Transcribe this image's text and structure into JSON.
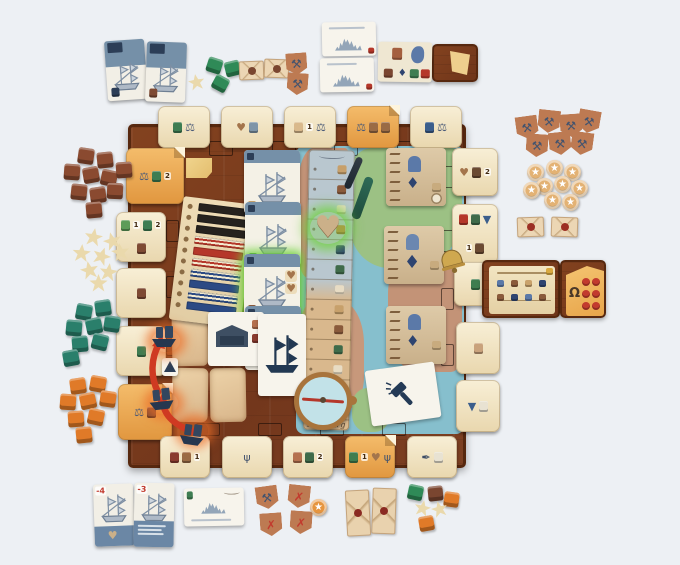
{
  "meta": {
    "scene": "Tabletop photo: board game set up mid-play (city-building/shipping game on wooden harbor board)",
    "background_color": "#edf0f4"
  },
  "labels": {
    "track_bottom": "Hamburg"
  },
  "corner_numbers": {
    "bottom_ship_card_1": "-4",
    "bottom_ship_card_2": "-3"
  },
  "icons": {
    "heart": {
      "g": "♥",
      "c": "#a4754c"
    },
    "scale": {
      "g": "⚖",
      "c": "#4a5a78"
    },
    "star": {
      "g": "★",
      "c": "#ffffff"
    },
    "cross": {
      "g": "✗",
      "c": "#c23b2e"
    },
    "tools": {
      "g": "⚒",
      "c": "#44546e"
    },
    "trident": {
      "g": "ψ",
      "c": "#44546e"
    },
    "quill": {
      "g": "✒",
      "c": "#3c4c66"
    },
    "diamond": {
      "g": "♦",
      "c": "#2e4470"
    },
    "horseshoe": {
      "g": "Ω",
      "c": "#4a3828"
    },
    "funnel": {
      "g": "▼",
      "c": "#3b5e8c"
    },
    "jug": {
      "c": "#3e7d52"
    },
    "sack": {
      "c": "#9a6b45"
    },
    "pouch": {
      "c": "#7e4a33"
    },
    "bottle": {
      "c": "#3b5e8c"
    },
    "jar": {
      "c": "#3f7d4f"
    },
    "candle_red": {
      "c": "#b5372a"
    },
    "candle_green": {
      "c": "#3f6b4a"
    },
    "leaf": {
      "c": "#5d9c59"
    },
    "seal": {
      "c": "#8a3b2f"
    },
    "doc": {
      "c": "#e8e2d2"
    },
    "pig": {
      "c": "#c9a27c"
    },
    "mountain": {
      "c": "#7f95a8"
    },
    "shield": {
      "c": "#b5714f"
    },
    "leather": {
      "c": "#d9b98c"
    },
    "pot": {
      "c": "#6b4a32"
    }
  },
  "board": {
    "wood_color": "#7b3d20",
    "edge_color": "#57280f",
    "track": {
      "bottom_label": "Hamburg",
      "row_colors": [
        "#c7a06b",
        "#8a5a3b",
        "#e8dcc4",
        "#b8893f",
        "#2e4470",
        "#3f6b4a",
        "#e8dcc4",
        "#c7a06b",
        "#8a5a3b",
        "#3f6b4a",
        "#e8dcc4",
        "#b8893f",
        "#c7a06b"
      ]
    },
    "slot_outlines": [
      [
        209,
        141,
        24,
        15
      ],
      [
        272,
        141,
        24,
        15
      ],
      [
        334,
        141,
        24,
        15
      ],
      [
        397,
        141,
        24,
        15
      ],
      [
        166,
        163,
        13,
        22
      ],
      [
        166,
        220,
        13,
        22
      ],
      [
        166,
        276,
        13,
        22
      ],
      [
        166,
        334,
        13,
        22
      ],
      [
        441,
        166,
        13,
        22
      ],
      [
        441,
        230,
        13,
        22
      ],
      [
        441,
        288,
        13,
        22
      ],
      [
        441,
        344,
        13,
        22
      ],
      [
        196,
        423,
        24,
        13
      ],
      [
        258,
        423,
        24,
        13
      ],
      [
        320,
        423,
        24,
        13
      ],
      [
        382,
        423,
        24,
        13
      ]
    ],
    "edge_cards": [
      {
        "name": "top-edge-card-1",
        "x": 158,
        "y": 106,
        "w": 52,
        "h": 42,
        "icons": [
          {
            "k": "jug"
          },
          {
            "k": "scale"
          }
        ]
      },
      {
        "name": "top-edge-card-2",
        "x": 221,
        "y": 106,
        "w": 52,
        "h": 42,
        "icons": [
          {
            "k": "heart"
          },
          {
            "k": "mountain"
          }
        ]
      },
      {
        "name": "top-edge-card-3",
        "x": 284,
        "y": 106,
        "w": 52,
        "h": 42,
        "icons": [
          {
            "k": "leather",
            "n": "1"
          },
          {
            "k": "scale"
          }
        ]
      },
      {
        "name": "top-edge-card-4",
        "x": 347,
        "y": 106,
        "w": 52,
        "h": 42,
        "variant": "orange",
        "icons": [
          {
            "k": "scale"
          },
          {
            "k": "sack"
          },
          {
            "k": "sack"
          }
        ]
      },
      {
        "name": "top-edge-card-5",
        "x": 410,
        "y": 106,
        "w": 52,
        "h": 42,
        "icons": [
          {
            "k": "bottle"
          },
          {
            "k": "scale"
          }
        ]
      },
      {
        "name": "top-left-corner-card",
        "x": 126,
        "y": 148,
        "w": 58,
        "h": 56,
        "variant": "orange",
        "icons": [
          {
            "k": "scale"
          },
          {
            "k": "jug",
            "n": "2"
          }
        ]
      },
      {
        "name": "left-edge-card-2",
        "x": 116,
        "y": 212,
        "w": 50,
        "h": 50,
        "icons": [
          {
            "k": "leaf",
            "n": "1"
          },
          {
            "k": "jug",
            "n": "2"
          },
          {
            "k": "pouch"
          }
        ]
      },
      {
        "name": "left-edge-card-3",
        "x": 116,
        "y": 268,
        "w": 50,
        "h": 50,
        "icons": [
          {
            "k": "pouch"
          }
        ]
      },
      {
        "name": "left-edge-card-4",
        "x": 116,
        "y": 326,
        "w": 50,
        "h": 50,
        "icons": [
          {
            "k": "jug"
          }
        ]
      },
      {
        "name": "bottom-left-corner-card",
        "x": 118,
        "y": 384,
        "w": 54,
        "h": 56,
        "variant": "orange",
        "icons": [
          {
            "k": "scale"
          },
          {
            "k": "pouch"
          }
        ]
      },
      {
        "name": "right-edge-card-1",
        "x": 452,
        "y": 148,
        "w": 46,
        "h": 48,
        "icons": [
          {
            "k": "heart"
          },
          {
            "k": "pot",
            "n": "2"
          }
        ]
      },
      {
        "name": "right-edge-card-2",
        "x": 452,
        "y": 204,
        "w": 46,
        "h": 60,
        "icons": [
          {
            "k": "candle_red"
          },
          {
            "k": "candle_green"
          },
          {
            "k": "funnel",
            "n": "1"
          },
          {
            "k": "pot"
          }
        ]
      },
      {
        "name": "right-edge-card-3",
        "x": 454,
        "y": 262,
        "w": 42,
        "h": 44,
        "icons": [
          {
            "k": "jar"
          }
        ]
      },
      {
        "name": "right-edge-card-4",
        "x": 456,
        "y": 322,
        "w": 44,
        "h": 52,
        "icons": [
          {
            "k": "pig"
          }
        ]
      },
      {
        "name": "right-edge-card-5",
        "x": 456,
        "y": 380,
        "w": 44,
        "h": 52,
        "icons": [
          {
            "k": "funnel"
          },
          {
            "k": "doc"
          }
        ]
      },
      {
        "name": "bottom-edge-card-1",
        "x": 160,
        "y": 436,
        "w": 50,
        "h": 42,
        "icons": [
          {
            "k": "seal"
          },
          {
            "k": "sack",
            "n": "1"
          }
        ]
      },
      {
        "name": "bottom-edge-card-2",
        "x": 222,
        "y": 436,
        "w": 50,
        "h": 42,
        "icons": [
          {
            "k": "trident"
          }
        ]
      },
      {
        "name": "bottom-edge-card-3",
        "x": 283,
        "y": 436,
        "w": 50,
        "h": 42,
        "icons": [
          {
            "k": "shield"
          },
          {
            "k": "candle_green",
            "n": "2"
          }
        ]
      },
      {
        "name": "bottom-edge-card-4",
        "x": 345,
        "y": 436,
        "w": 50,
        "h": 42,
        "variant": "orange",
        "icons": [
          {
            "k": "jar",
            "n": "1"
          },
          {
            "k": "heart"
          },
          {
            "k": "trident"
          }
        ]
      },
      {
        "name": "bottom-edge-card-5",
        "x": 407,
        "y": 436,
        "w": 50,
        "h": 42,
        "icons": [
          {
            "k": "quill"
          },
          {
            "k": "doc"
          }
        ]
      }
    ]
  },
  "score_panel": {
    "rows": [
      "black",
      "black",
      "black",
      "red_stripe",
      "red",
      "red_stripe",
      "blue_stripe",
      "blue",
      "blue_stripe",
      "blue"
    ]
  },
  "token_piles": [
    {
      "name": "brown-goods-cubes",
      "shape": "cube",
      "size": 16,
      "color": "#8a4a30",
      "items": [
        [
          78,
          148,
          8
        ],
        [
          97,
          152,
          -6
        ],
        [
          64,
          164,
          4
        ],
        [
          83,
          167,
          -10
        ],
        [
          101,
          170,
          12
        ],
        [
          116,
          162,
          -4
        ],
        [
          71,
          184,
          6
        ],
        [
          90,
          187,
          -8
        ],
        [
          107,
          183,
          3
        ],
        [
          86,
          202,
          -5
        ]
      ]
    },
    {
      "name": "cream-star-meeples",
      "shape": "star",
      "size": 19,
      "color": "#ead9ac",
      "items": [
        [
          84,
          228,
          10
        ],
        [
          103,
          232,
          -15
        ],
        [
          72,
          244,
          5
        ],
        [
          92,
          247,
          20
        ],
        [
          111,
          243,
          -8
        ],
        [
          80,
          261,
          -12
        ],
        [
          99,
          263,
          8
        ],
        [
          89,
          274,
          0
        ]
      ]
    },
    {
      "name": "teal-goods-cubes",
      "shape": "cube",
      "size": 16,
      "color": "#2a7f6b",
      "items": [
        [
          76,
          304,
          10
        ],
        [
          95,
          300,
          -8
        ],
        [
          66,
          320,
          5
        ],
        [
          86,
          318,
          -12
        ],
        [
          104,
          316,
          8
        ],
        [
          72,
          336,
          -5
        ],
        [
          92,
          334,
          14
        ],
        [
          63,
          350,
          -10
        ]
      ]
    },
    {
      "name": "orange-goods-cubes",
      "shape": "cube",
      "size": 16,
      "color": "#e07a28",
      "items": [
        [
          70,
          378,
          -8
        ],
        [
          90,
          376,
          10
        ],
        [
          60,
          394,
          4
        ],
        [
          80,
          393,
          -12
        ],
        [
          100,
          391,
          8
        ],
        [
          68,
          411,
          -4
        ],
        [
          88,
          409,
          12
        ],
        [
          76,
          427,
          -6
        ]
      ]
    },
    {
      "name": "green-goods-cubes",
      "shape": "cube",
      "size": 15,
      "color": "#2f8a57",
      "items": [
        [
          207,
          58,
          18
        ],
        [
          225,
          61,
          -14
        ],
        [
          213,
          76,
          28
        ]
      ]
    },
    {
      "name": "cream-star-meeple-single",
      "shape": "star",
      "size": 17,
      "color": "#ead9ac",
      "items": [
        [
          188,
          74,
          -10
        ]
      ]
    },
    {
      "name": "letter-tokens-brown-seal",
      "shape": "env",
      "size": 25,
      "color": "#ecd6b4",
      "seal": "#7a4630",
      "items": [
        [
          239,
          61,
          -2
        ],
        [
          264,
          59,
          2
        ]
      ]
    },
    {
      "name": "guild-badges-top-left",
      "shape": "badge",
      "size": 21,
      "color": "#bd7a52",
      "glyph": "tools",
      "items": [
        [
          286,
          53,
          -4
        ],
        [
          287,
          73,
          4
        ]
      ]
    },
    {
      "name": "guild-badges-pile",
      "shape": "badge",
      "size": 22,
      "color": "#bd7a52",
      "glyph": "tools",
      "items": [
        [
          516,
          116,
          -8
        ],
        [
          538,
          110,
          6
        ],
        [
          560,
          114,
          -4
        ],
        [
          578,
          110,
          10
        ],
        [
          526,
          134,
          4
        ],
        [
          549,
          132,
          -6
        ],
        [
          571,
          132,
          8
        ]
      ]
    },
    {
      "name": "star-coins-pile",
      "shape": "coin",
      "size": 17,
      "color": "#e3b274",
      "glyph": "star",
      "items": [
        [
          527,
          164,
          0
        ],
        [
          546,
          160,
          0
        ],
        [
          564,
          164,
          0
        ],
        [
          536,
          178,
          0
        ],
        [
          554,
          176,
          0
        ],
        [
          571,
          180,
          0
        ],
        [
          523,
          182,
          0
        ],
        [
          544,
          192,
          0
        ],
        [
          562,
          194,
          0
        ]
      ]
    },
    {
      "name": "letter-tokens-red-seal",
      "shape": "env",
      "size": 27,
      "color": "#ecd6b4",
      "seal": "#9c2f24",
      "items": [
        [
          517,
          217,
          -2
        ],
        [
          551,
          217,
          2
        ]
      ]
    },
    {
      "name": "badge-crossed-tools",
      "shape": "badge",
      "size": 22,
      "color": "#bd7a52",
      "glyph": "tools",
      "items": [
        [
          256,
          486,
          -8
        ]
      ]
    },
    {
      "name": "badges-red-x",
      "shape": "badge",
      "size": 22,
      "color": "#bd7a52",
      "glyph": "cross",
      "items": [
        [
          288,
          485,
          6
        ],
        [
          260,
          513,
          -4
        ],
        [
          290,
          511,
          4
        ]
      ]
    },
    {
      "name": "orange-star-coin",
      "shape": "coin",
      "size": 17,
      "color": "#e6953f",
      "glyph": "star",
      "items": [
        [
          310,
          499,
          0
        ]
      ]
    },
    {
      "name": "letter-tokens-portrait",
      "shape": "envp",
      "size": 24,
      "color": "#e9d2ae",
      "seal": "#8a2a22",
      "items": [
        [
          346,
          490,
          -3
        ],
        [
          372,
          488,
          2
        ]
      ]
    },
    {
      "name": "mixed-green-cube",
      "shape": "cube",
      "size": 15,
      "color": "#2f8a57",
      "items": [
        [
          408,
          485,
          12
        ]
      ]
    },
    {
      "name": "mixed-brown-cube",
      "shape": "cube",
      "size": 15,
      "color": "#7a4630",
      "items": [
        [
          428,
          486,
          -6
        ]
      ]
    },
    {
      "name": "mixed-orange-cubes",
      "shape": "cube",
      "size": 15,
      "color": "#e07a28",
      "items": [
        [
          444,
          492,
          8
        ],
        [
          419,
          516,
          -10
        ]
      ]
    },
    {
      "name": "mixed-star-meeples",
      "shape": "star",
      "size": 17,
      "color": "#ead9ac",
      "items": [
        [
          414,
          500,
          12
        ],
        [
          431,
          501,
          -14
        ]
      ]
    }
  ]
}
